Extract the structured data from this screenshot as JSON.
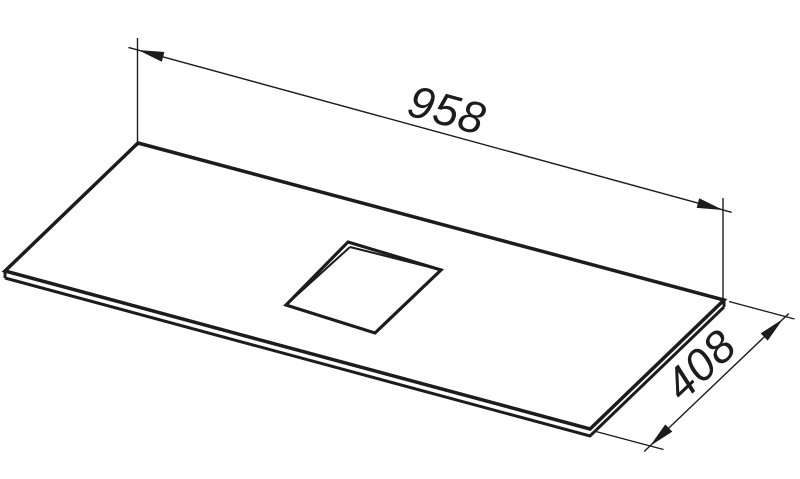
{
  "page": {
    "background_color": "#ffffff",
    "line_color": "#1c1c1c"
  },
  "drawing": {
    "dimensions": {
      "length": {
        "value": "958"
      },
      "depth": {
        "value": "408"
      }
    }
  }
}
